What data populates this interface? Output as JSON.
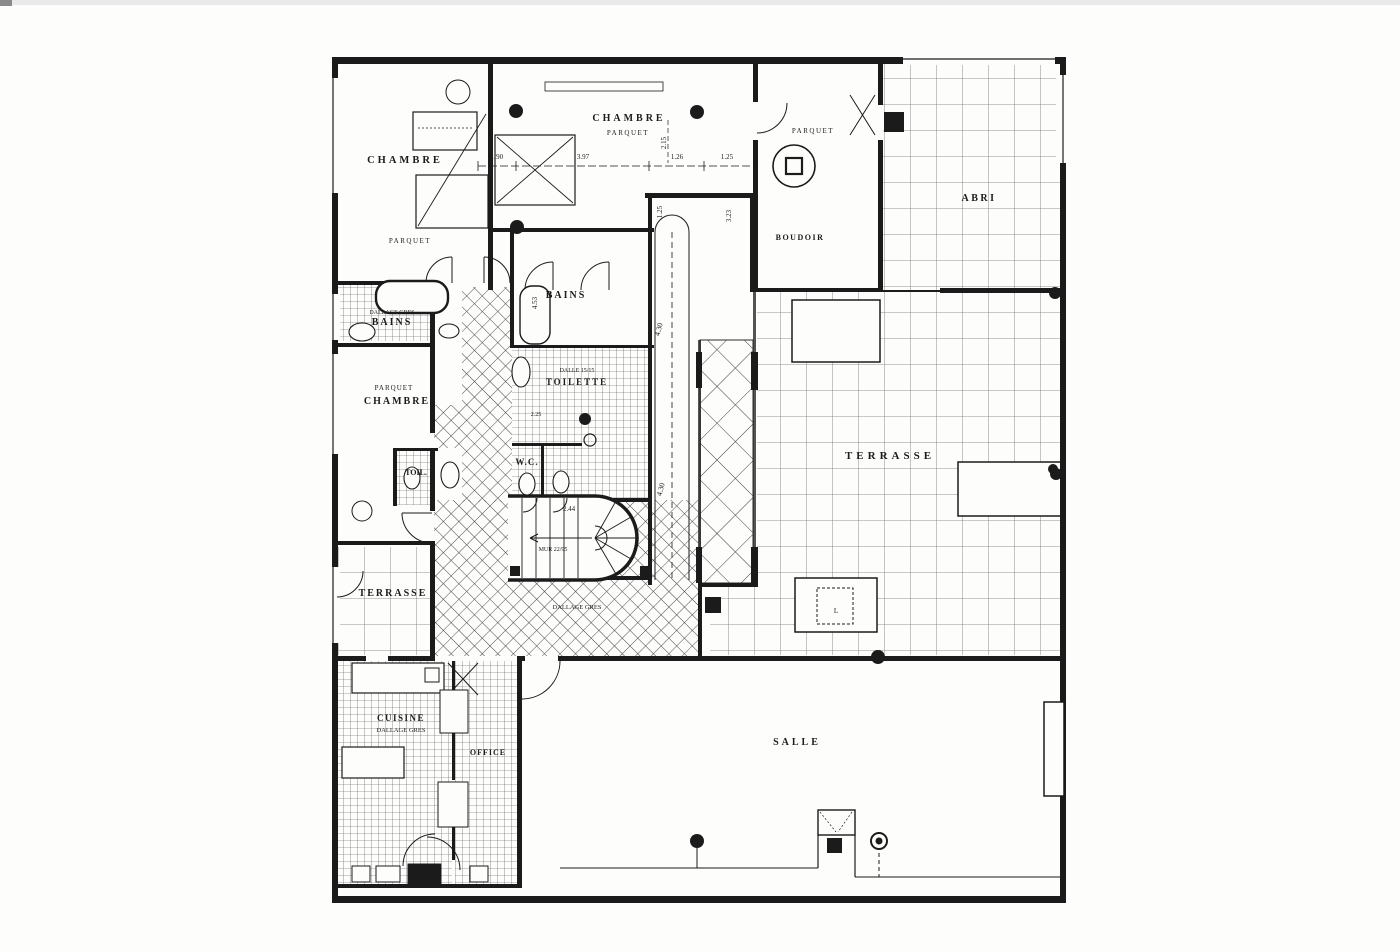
{
  "page": {
    "background": "#fdfdfc",
    "ink": "#1b1b1b"
  },
  "labels": {
    "chambre_nw": "CHAMBRE",
    "parquet_nw": "PARQUET",
    "chambre_n": "CHAMBRE",
    "parquet_n": "PARQUET",
    "boudoir": "BOUDOIR",
    "parquet_boudoir": "PARQUET",
    "abri": "ABRI",
    "bains_w": "BAINS",
    "bains_c": "BAINS",
    "chambre_w": "CHAMBRE",
    "parquet_w": "PARQUET",
    "toilette": "TOILETTE",
    "wc": "W.C.",
    "toil": "TOIL.",
    "terrasse_w": "TERRASSE",
    "terrasse_e": "TERRASSE",
    "cuisine": "CUISINE",
    "office": "OFFICE",
    "salle": "SALLE"
  },
  "notes": {
    "bains_w_note": "DALLAGE GRES",
    "toilette_note": "DALLE 15/15",
    "cuisine_note": "DALLAGE GRES",
    "hall_note": "DALLAGE GRES",
    "stair_note": "MUR 22/95"
  },
  "dims": {
    "d190": "1.90",
    "d397": "3.97",
    "d126": "1.26",
    "d125a": "1.25",
    "d215": "2.15",
    "d323": "3.23",
    "d125b": "1.25",
    "d430a": "4.30",
    "d430b": "4.30",
    "d453": "4.53",
    "d225": "2.25",
    "d244": "2.44",
    "table_l": "L"
  }
}
